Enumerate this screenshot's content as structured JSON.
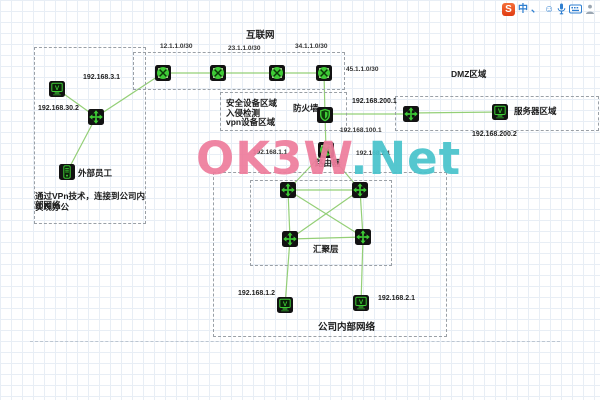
{
  "input_bar": {
    "logo_text": "S",
    "mode_label": "中",
    "punct_label": "、",
    "smiley_glyph": "☺",
    "icon_names": [
      "sogou-logo",
      "input-mode-toggle",
      "punctuation-toggle",
      "emoji-icon",
      "microphone-icon",
      "keyboard-icon",
      "toolbox-icon"
    ]
  },
  "labels": {
    "internet": "互联网",
    "net12": "12.1.1.0/30",
    "net23": "23.1.1.0/30",
    "net34": "34.1.1.0/30",
    "net45": "45.1.1.0/30",
    "switch3_ip": "192.168.3.1",
    "pc30_ip": "192.168.30.2",
    "external_staff": "外部员工",
    "vpn_note1": "通过VPn技术，连接到公司内部网络",
    "vpn_note2": "实现办公",
    "sec1": "安全设备区域",
    "sec2": "入侵检测",
    "sec3": "vpn设备区域",
    "firewall": "防火墙",
    "fw_dmz_ip": "192.168.200.1",
    "dmz": "DMZ区域",
    "server_area": "服务器区域",
    "dmz_server_ip": "192.168.200.2",
    "fw_router_ip": "192.168.100.1",
    "router": "路由器",
    "router_left_ip": "192.168.1.1",
    "router_right_ip": "192.168.2.1",
    "aggregation": "汇聚层",
    "internal": "公司内部网络",
    "host_left_ip": "192.168.1.2",
    "host_right_ip": "192.168.2.1"
  },
  "watermark": {
    "part1": "OK3W",
    "part2": ".Net"
  },
  "icon_names": {
    "router": "router-icon",
    "switch": "switch-icon",
    "firewall": "firewall-shield-icon",
    "host": "pc-host-icon",
    "device": "mobile-device-icon"
  },
  "colors": {
    "line_green": "#8fcd70",
    "icon_green": "#3ecb36",
    "icon_bg": "#121212",
    "region_dash": "#9aa0a6",
    "grid": "#e8eef5",
    "watermark_pink": "#ee7d9d",
    "watermark_teal": "#49c3cc",
    "sogou_orange": "#e9511f",
    "toolbar_blue": "#2f7fd0"
  }
}
